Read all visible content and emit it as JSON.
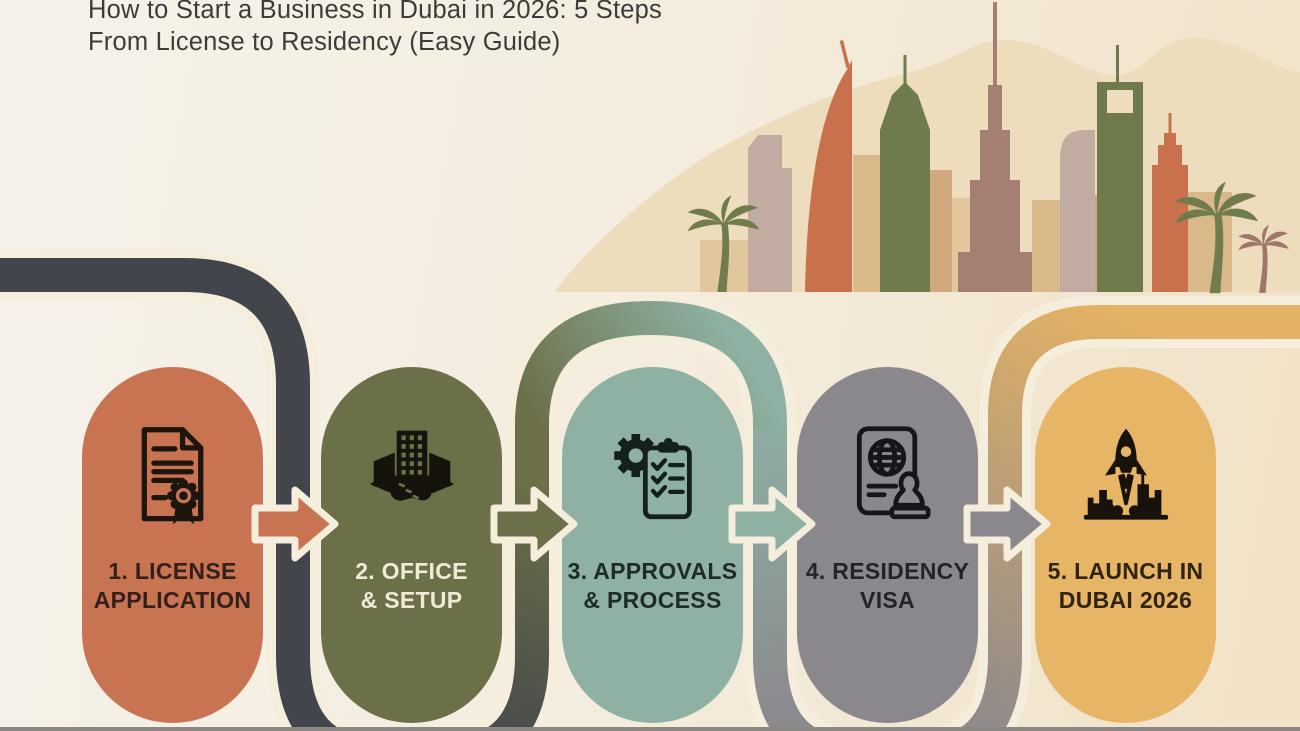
{
  "title": {
    "line1": "How to Start a Business in Dubai in 2026: 5 Steps",
    "line2": "From License to Residency (Easy Guide)"
  },
  "steps": [
    {
      "label_line1": "1. LICENSE",
      "label_line2": "APPLICATION",
      "color": "#c87453",
      "text_color": "#33201a",
      "icon": "certificate-seal-icon"
    },
    {
      "label_line1": "2. OFFICE",
      "label_line2": "& SETUP",
      "color": "#6b7048",
      "text_color": "#f0ead6",
      "icon": "office-handshake-icon"
    },
    {
      "label_line1": "3. APPROVALS",
      "label_line2": "& PROCESS",
      "color": "#8eb1a3",
      "text_color": "#1f2b26",
      "icon": "gear-checklist-icon"
    },
    {
      "label_line1": "4. RESIDENCY",
      "label_line2": "VISA",
      "color": "#8b888d",
      "text_color": "#262229",
      "icon": "passport-stamp-icon"
    },
    {
      "label_line1": "5. LAUNCH IN",
      "label_line2": "DUBAI 2026",
      "color": "#e6b566",
      "text_color": "#312413",
      "icon": "rocket-launch-icon"
    }
  ],
  "flow_path": {
    "outline_color": "#f5eedd",
    "segment_colors": {
      "dark": "#42454c",
      "olive": "#6b7048",
      "teal": "#8eb1a3",
      "gray": "#8b888d",
      "gold": "#e4b264"
    }
  },
  "arrows": [
    {
      "color": "#c87453"
    },
    {
      "color": "#6b7048"
    },
    {
      "color": "#8eb1a3"
    },
    {
      "color": "#8b888d"
    }
  ],
  "skyline": {
    "blob_color": "#edddbc",
    "colors": {
      "orange": "#c9714d",
      "green": "#6f7b4a",
      "mauve": "#a57f72",
      "tan": "#d9b98a",
      "tan_light": "#e2c79d",
      "tan_deep": "#cfa87e",
      "gray_mauve": "#c2aca1",
      "palm_green": "#717c4c",
      "palm_brown": "#a1766a"
    }
  },
  "background": {
    "left": "#f6f2ea",
    "right": "#f2e2c6",
    "bottom_bar": "#8b8884"
  }
}
